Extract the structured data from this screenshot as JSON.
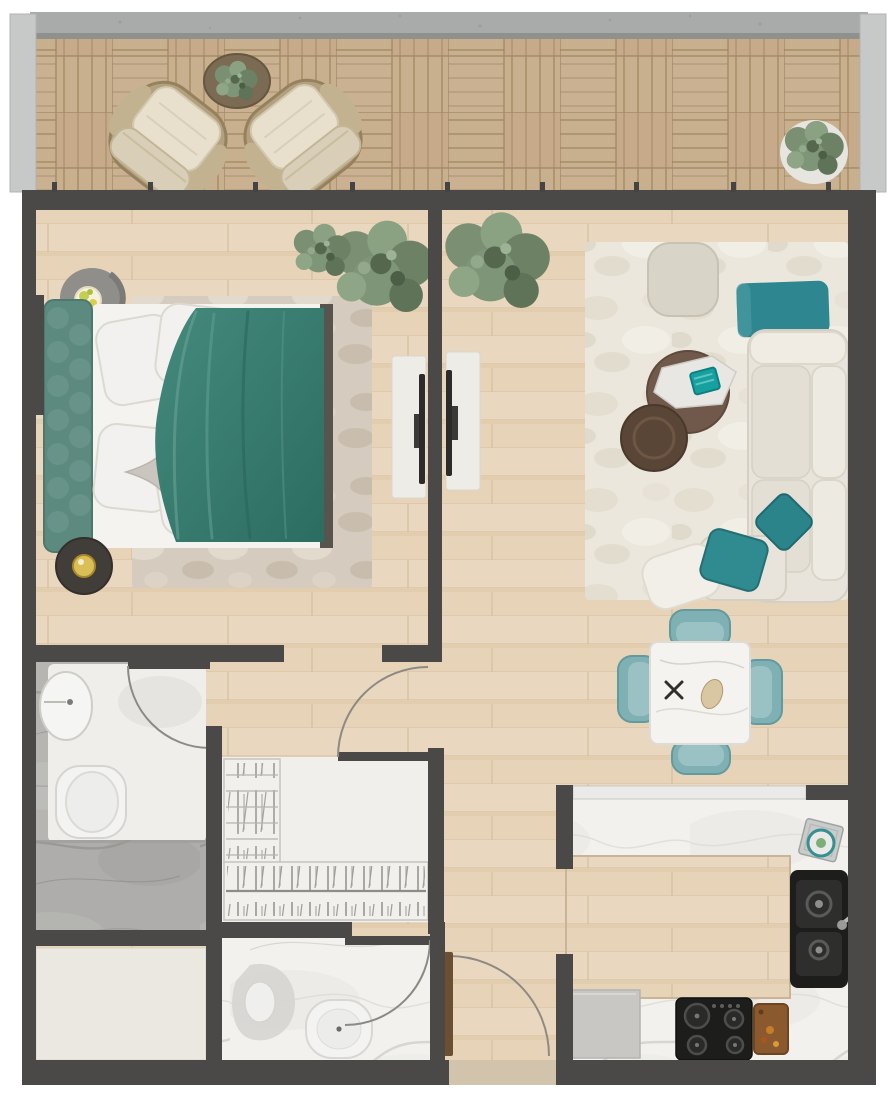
{
  "scene": {
    "type": "floor-plan",
    "view": "top-down-render",
    "description": "one-bedroom apartment floor plan with balcony",
    "text_labels": []
  },
  "palette": {
    "wall": "#4a4948",
    "woodFloor": "#e7d4b8",
    "deckWood": "#c8af8e",
    "concreteRail": "#a9abaa",
    "glassRail": "#c7c9c8",
    "teal": "#2e8690",
    "tealSoft": "#7fb0b4",
    "duvetTeal": "#3a8175",
    "marbleWhite": "#f2f1ee",
    "marbleGray": "#b6b5b2",
    "rugCream": "#ebe7dc",
    "rugBeige": "#d5ccbf",
    "sofaCream": "#e8e4db",
    "fixtureWhite": "#f3f3f1",
    "tableBrown": "#70594a",
    "applianceBlack": "#1d1d1c",
    "doorBrown": "#6b4f35",
    "closetWhite": "#f0efeb",
    "storageFloor": "#ebe8e1",
    "plantGreen": "#7b9073",
    "lampGold": "#d9bf55"
  },
  "rooms": [
    {
      "name": "balcony",
      "items": [
        "basket-weave-deck",
        "concrete-rail",
        "glass-side-panels",
        "wicker-armchair",
        "wicker-armchair",
        "round-side-table",
        "potted-plant",
        "potted-plant"
      ]
    },
    {
      "name": "bedroom",
      "items": [
        "double-bed",
        "teal-duvet",
        "white-pillows",
        "star-pillow",
        "tufted-headboard",
        "nightstand-with-lamp",
        "nightstand-with-lamp",
        "area-rug",
        "potted-plants",
        "tv-console",
        "wall-tv"
      ]
    },
    {
      "name": "living-room",
      "items": [
        "cream-sofa",
        "teal-cushion",
        "teal-cushion",
        "white-cushion",
        "teal-bench",
        "square-pouf",
        "round-coffee-table",
        "round-side-table",
        "tray-with-teal-box",
        "cream-area-rug",
        "potted-plant",
        "tv-console",
        "wall-tv"
      ]
    },
    {
      "name": "dining-area",
      "items": [
        "square-marble-table",
        "teal-dining-chair",
        "teal-dining-chair",
        "teal-dining-chair",
        "teal-dining-chair",
        "crossed-cutlery",
        "bread-item"
      ]
    },
    {
      "name": "kitchen",
      "items": [
        "wood-island-floor",
        "u-shaped-marble-counter",
        "black-double-sink",
        "chrome-faucet",
        "gas-hob-four-burner",
        "cutting-board",
        "stacked-dishes",
        "gray-appliance-front",
        "pass-through-counter"
      ]
    },
    {
      "name": "ensuite-bathroom",
      "items": [
        "oval-sink",
        "toilet",
        "vanity-zone",
        "shower-zone",
        "door-swing"
      ]
    },
    {
      "name": "guest-bathroom",
      "items": [
        "corner-basin",
        "round-toilet",
        "door-swing"
      ]
    },
    {
      "name": "walk-in-closet",
      "items": [
        "shelf-unit",
        "hanging-rail-with-hangers",
        "door-swing"
      ]
    },
    {
      "name": "entry-hall",
      "items": [
        "entry-door",
        "door-swing"
      ]
    },
    {
      "name": "storage-room",
      "items": []
    }
  ],
  "counts": {
    "doors": 4,
    "window_mullions": 9,
    "dining_chairs": 4,
    "balcony_armchairs": 2,
    "plants": 5
  }
}
